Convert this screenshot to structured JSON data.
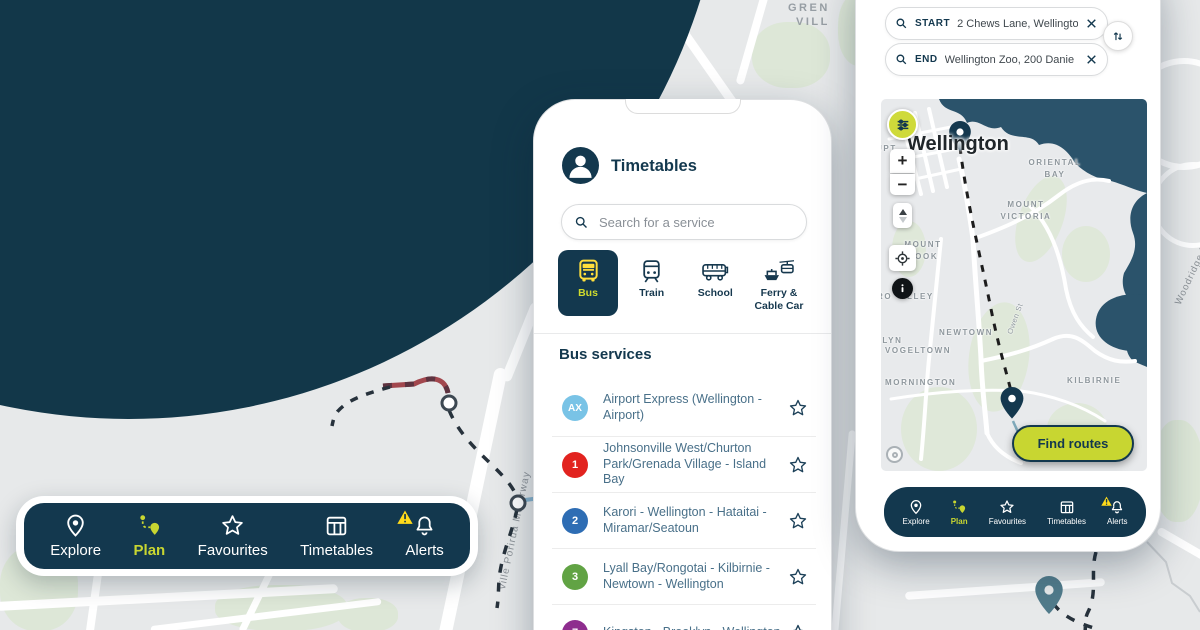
{
  "brand": {
    "navy": "#13384e",
    "citron": "#c8d631",
    "yellow": "#ffda1a"
  },
  "nav": {
    "items": [
      {
        "label": "Explore",
        "icon": "location-pin-icon",
        "active": false
      },
      {
        "label": "Plan",
        "icon": "route-plan-icon",
        "active": true
      },
      {
        "label": "Favourites",
        "icon": "star-icon",
        "active": false
      },
      {
        "label": "Timetables",
        "icon": "timetable-grid-icon",
        "active": false
      },
      {
        "label": "Alerts",
        "icon": "alert-bell-icon",
        "active": false
      }
    ]
  },
  "timetables_screen": {
    "title": "Timetables",
    "search_placeholder": "Search for a service",
    "tabs": [
      {
        "label": "Bus",
        "active": true
      },
      {
        "label": "Train",
        "active": false
      },
      {
        "label": "School",
        "active": false
      },
      {
        "label": "Ferry & Cable Car",
        "active": false
      }
    ],
    "section_heading": "Bus services",
    "services": [
      {
        "badge": "AX",
        "badge_color": "#79c3e6",
        "name": "Airport Express (Wellington - Airport)"
      },
      {
        "badge": "1",
        "badge_color": "#e2231f",
        "name": "Johnsonville West/Churton Park/Grenada Village - Island Bay"
      },
      {
        "badge": "2",
        "badge_color": "#2e6db4",
        "name": "Karori - Wellington - Hataitai - Miramar/Seatoun"
      },
      {
        "badge": "3",
        "badge_color": "#61a344",
        "name": "Lyall Bay/Rongotai - Kilbirnie - Newtown - Wellington"
      },
      {
        "badge": "7",
        "badge_color": "#8e2d8e",
        "name": "Kingston - Brooklyn - Wellington"
      }
    ]
  },
  "planner_screen": {
    "start": {
      "label": "START",
      "value": "2 Chews Lane, Wellingto"
    },
    "end": {
      "label": "END",
      "value": "Wellington Zoo, 200 Danie"
    },
    "find_routes_label": "Find routes",
    "zoom_in": "+",
    "zoom_out": "−",
    "map_labels": {
      "city": "Wellington",
      "oriental_bay": "ORIENTAL BAY",
      "mount_victoria": "MOUNT VICTORIA",
      "mount_cook": "MOUNT COOK",
      "vogeltown": "VOGELTOWN",
      "newtown": "NEWTOWN",
      "mornington": "MORNINGTON",
      "kilbirnie": "KILBIRNIE",
      "owen_st": "Owen St",
      "frag_top_left": "UPT",
      "frag_aro": "RO",
      "frag_valley": "LLEY",
      "frag_brooklyn": "KLYN"
    }
  },
  "background_map": {
    "grenada_line1": "GREN",
    "grenada_line2": "VILL",
    "motorway_label": "ville Porirua Motorway",
    "woodridge_label": "Woodridge Dr"
  }
}
